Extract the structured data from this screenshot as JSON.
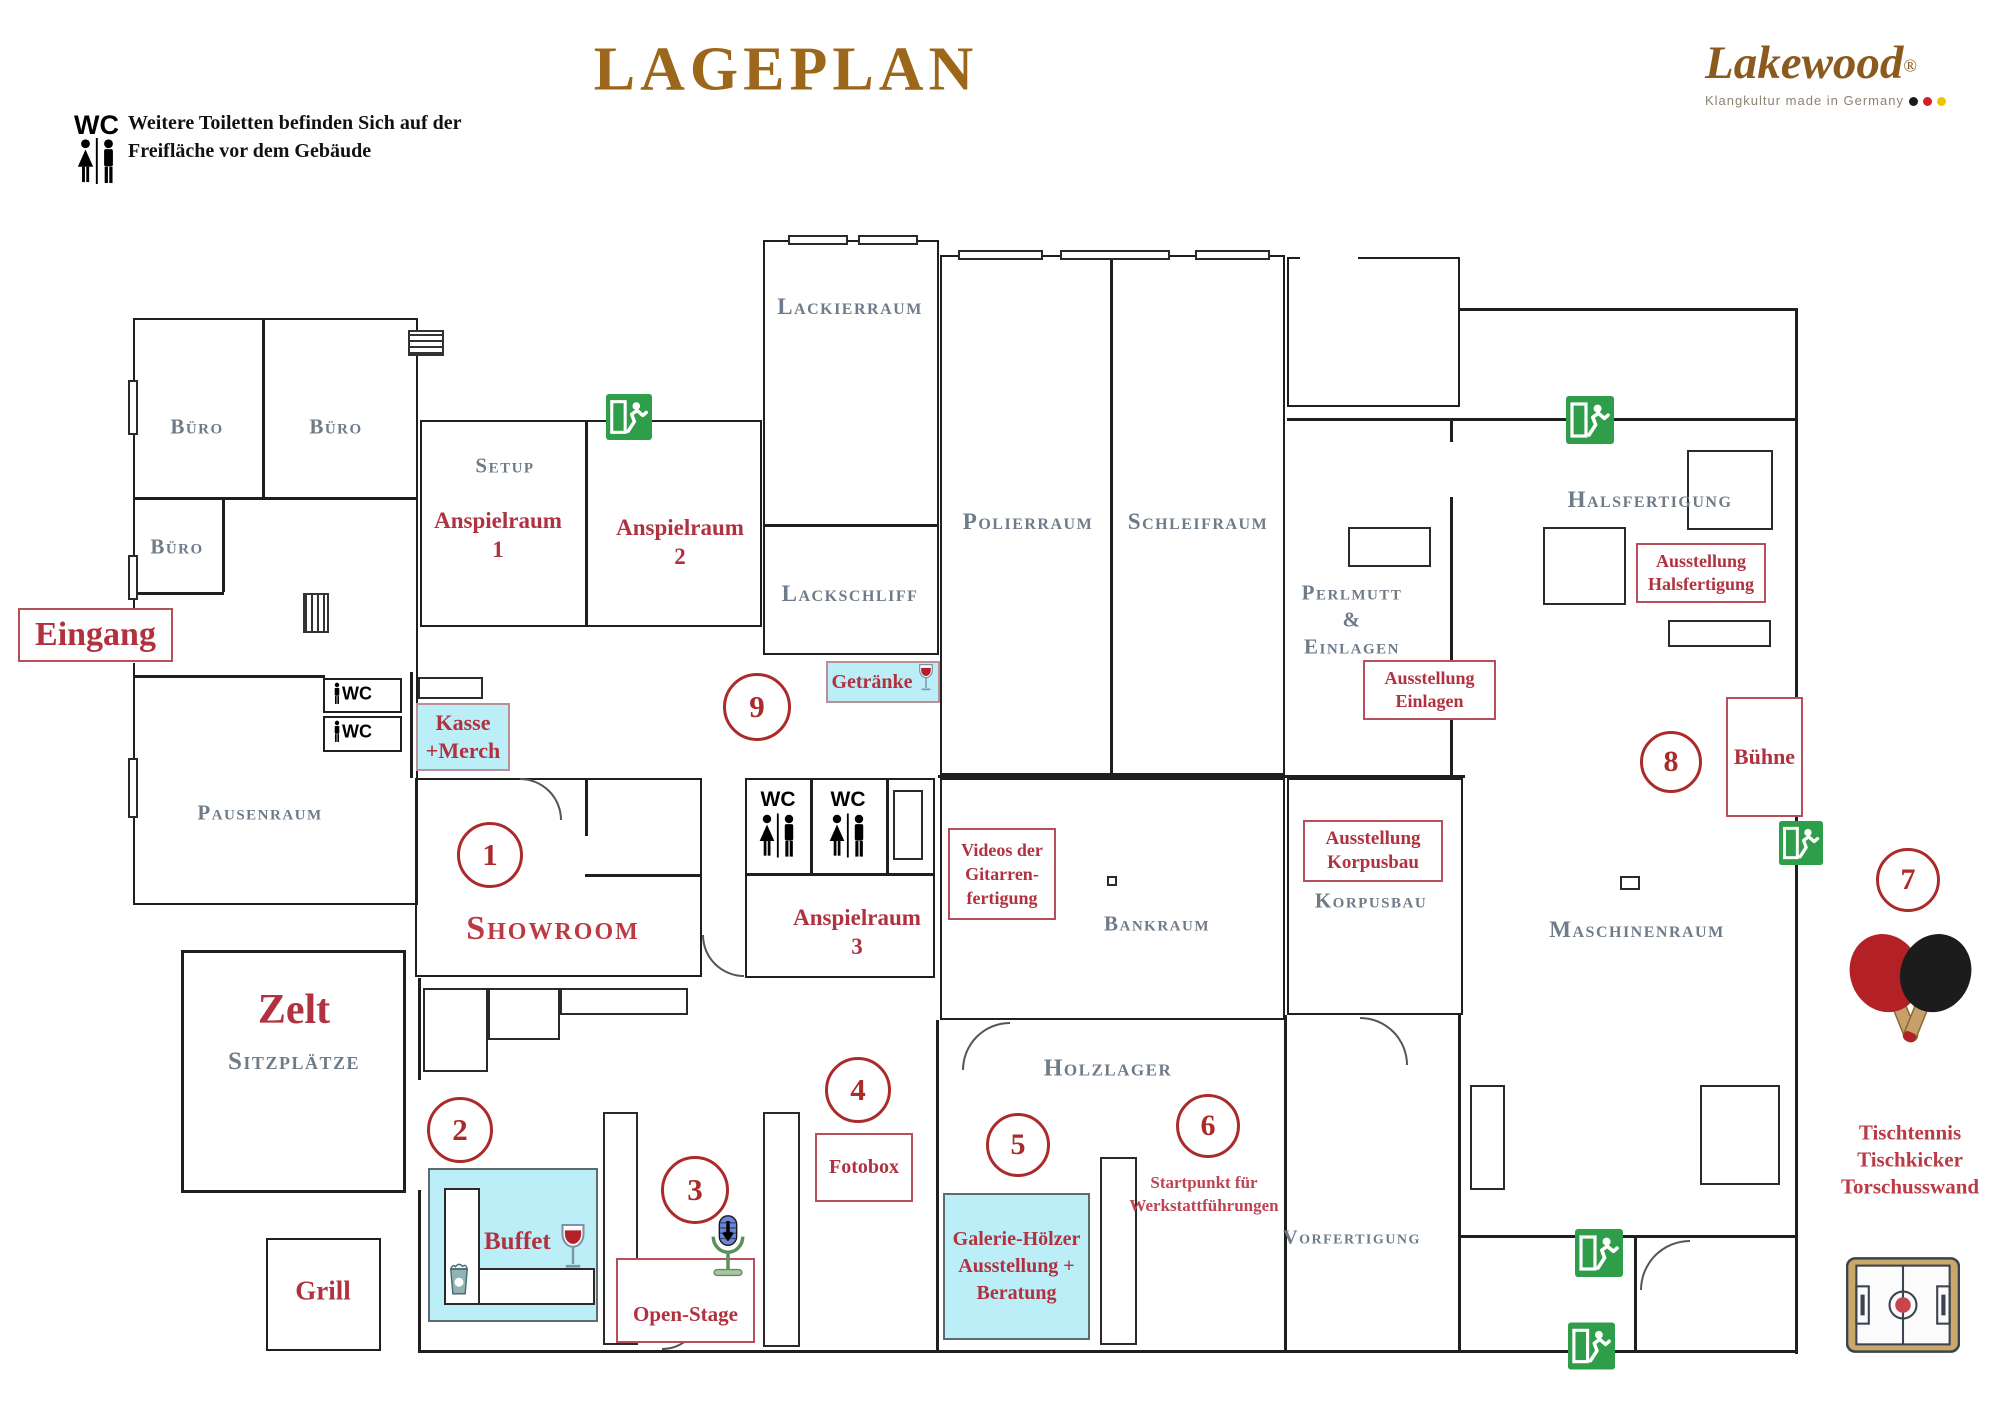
{
  "colors": {
    "title_brown": "#9c671b",
    "logo_brown": "#8a5a1f",
    "label_red": "#b03240",
    "circle_red": "#ab2b2b",
    "room_gray": "#6e7b89",
    "highlight_cyan": "#bceef7",
    "exit_green": "#2e9e4a"
  },
  "header": {
    "wc_badge": "WC",
    "note_1": "Weitere Toiletten befinden Sich auf der",
    "note_2": "Freifläche vor dem Gebäude",
    "title": "LAGEPLAN"
  },
  "logo": {
    "name": "Lakewood",
    "reg": "®",
    "tagline": "Klangkultur made in Germany"
  },
  "rooms": {
    "buero_1": "Büro",
    "buero_2": "Büro",
    "buero_3": "Büro",
    "setup": "Setup",
    "pausenraum": "Pausenraum",
    "lackierraum": "Lackierraum",
    "lackschliff": "Lackschliff",
    "polierraum": "Polierraum",
    "schleifraum": "Schleifraum",
    "perlmutt_1": "Perlmutt",
    "perlmutt_2": "&",
    "perlmutt_3": "Einlagen",
    "halsfertigung": "Halsfertigung",
    "bankraum": "Bankraum",
    "korpusbau": "Korpusbau",
    "maschinenraum": "Maschinenraum",
    "holzlager": "Holzlager",
    "vorfertigung": "Vorfertigung",
    "sitzplaetze": "Sitzplätze"
  },
  "areas": {
    "eingang": "Eingang",
    "anspielraum_1a": "Anspielraum",
    "anspielraum_1b": "1",
    "anspielraum_2a": "Anspielraum",
    "anspielraum_2b": "2",
    "anspielraum_3a": "Anspielraum",
    "anspielraum_3b": "3",
    "showroom": "Showroom",
    "zelt": "Zelt",
    "grill": "Grill",
    "startpunkt_1": "Startpunkt für",
    "startpunkt_2": "Werkstattführungen",
    "tischtennis_1": "Tischtennis",
    "tischtennis_2": "Tischkicker",
    "tischtennis_3": "Torschusswand"
  },
  "marker_boxes": {
    "kasse_1": "Kasse",
    "kasse_2": "+Merch",
    "getraenke": "Getränke",
    "buffet": "Buffet",
    "galerie_1": "Galerie-Hölzer",
    "galerie_2": "Ausstellung +",
    "galerie_3": "Beratung",
    "ausstellung_einlagen_1": "Ausstellung",
    "ausstellung_einlagen_2": "Einlagen",
    "ausstellung_halsfertigung_1": "Ausstellung",
    "ausstellung_halsfertigung_2": "Halsfertigung",
    "ausstellung_korpusbau_1": "Ausstellung",
    "ausstellung_korpusbau_2": "Korpusbau",
    "videos_1": "Videos der",
    "videos_2": "Gitarren-",
    "videos_3": "fertigung",
    "buehne": "Bühne",
    "fotobox": "Fotobox",
    "open_stage": "Open-Stage"
  },
  "stations": {
    "s1": "1",
    "s2": "2",
    "s3": "3",
    "s4": "4",
    "s5": "5",
    "s6": "6",
    "s7": "7",
    "s8": "8",
    "s9": "9"
  },
  "wc": {
    "label": "WC"
  }
}
